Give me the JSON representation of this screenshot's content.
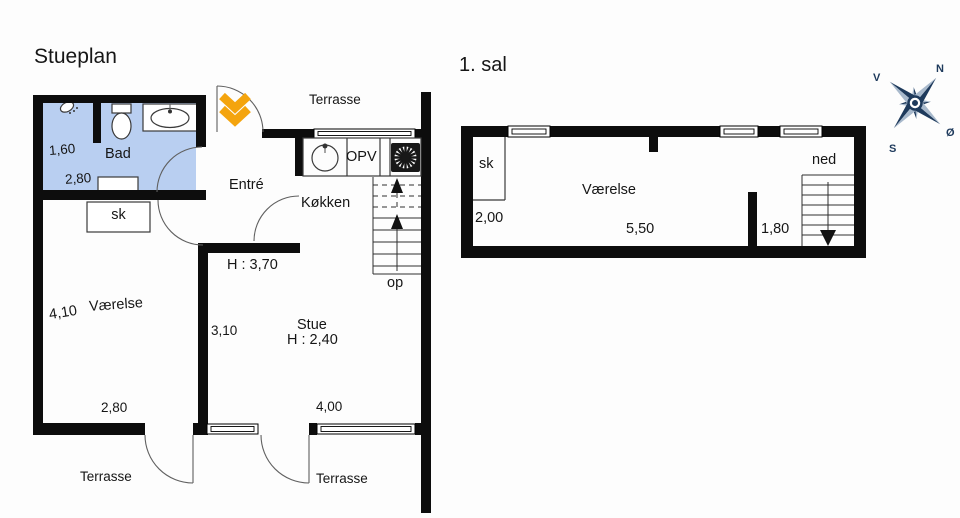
{
  "ground_floor": {
    "title": "Stueplan",
    "rooms": {
      "bad": "Bad",
      "sk": "sk",
      "entre": "Entré",
      "kokken": "Køkken",
      "vaerelse": "Værelse",
      "stue": "Stue"
    },
    "labels": {
      "terrasse_top": "Terrasse",
      "terrasse_bottom_left": "Terrasse",
      "terrasse_bottom_mid": "Terrasse",
      "dishwasher": "OPV",
      "stairs_up": "op"
    },
    "dimensions": {
      "bad_width": "1,60",
      "bad_length": "2,80",
      "vaerelse_depth": "4,10",
      "vaerelse_width": "2,80",
      "stue_depth": "3,10",
      "stue_width": "4,00"
    },
    "ceiling_heights": {
      "entre": "H : 3,70",
      "stue": "H : 2,40"
    }
  },
  "first_floor": {
    "title": "1. sal",
    "rooms": {
      "sk": "sk",
      "vaerelse": "Værelse"
    },
    "labels": {
      "stairs_down": "ned"
    },
    "dimensions": {
      "left_width": "2,00",
      "room_width": "5,50",
      "right_width": "1,80"
    }
  },
  "compass": {
    "north": "N",
    "south": "S",
    "east": "Ø",
    "west": "V"
  },
  "colors": {
    "wall": "#0d0d0d",
    "bath_fill": "#b9cff1",
    "chevron": "#f4a40d",
    "compass_dark": "#1e3a5c",
    "compass_light": "#a8b9cc",
    "ink": "#161616",
    "line": "#3a3a3a"
  }
}
